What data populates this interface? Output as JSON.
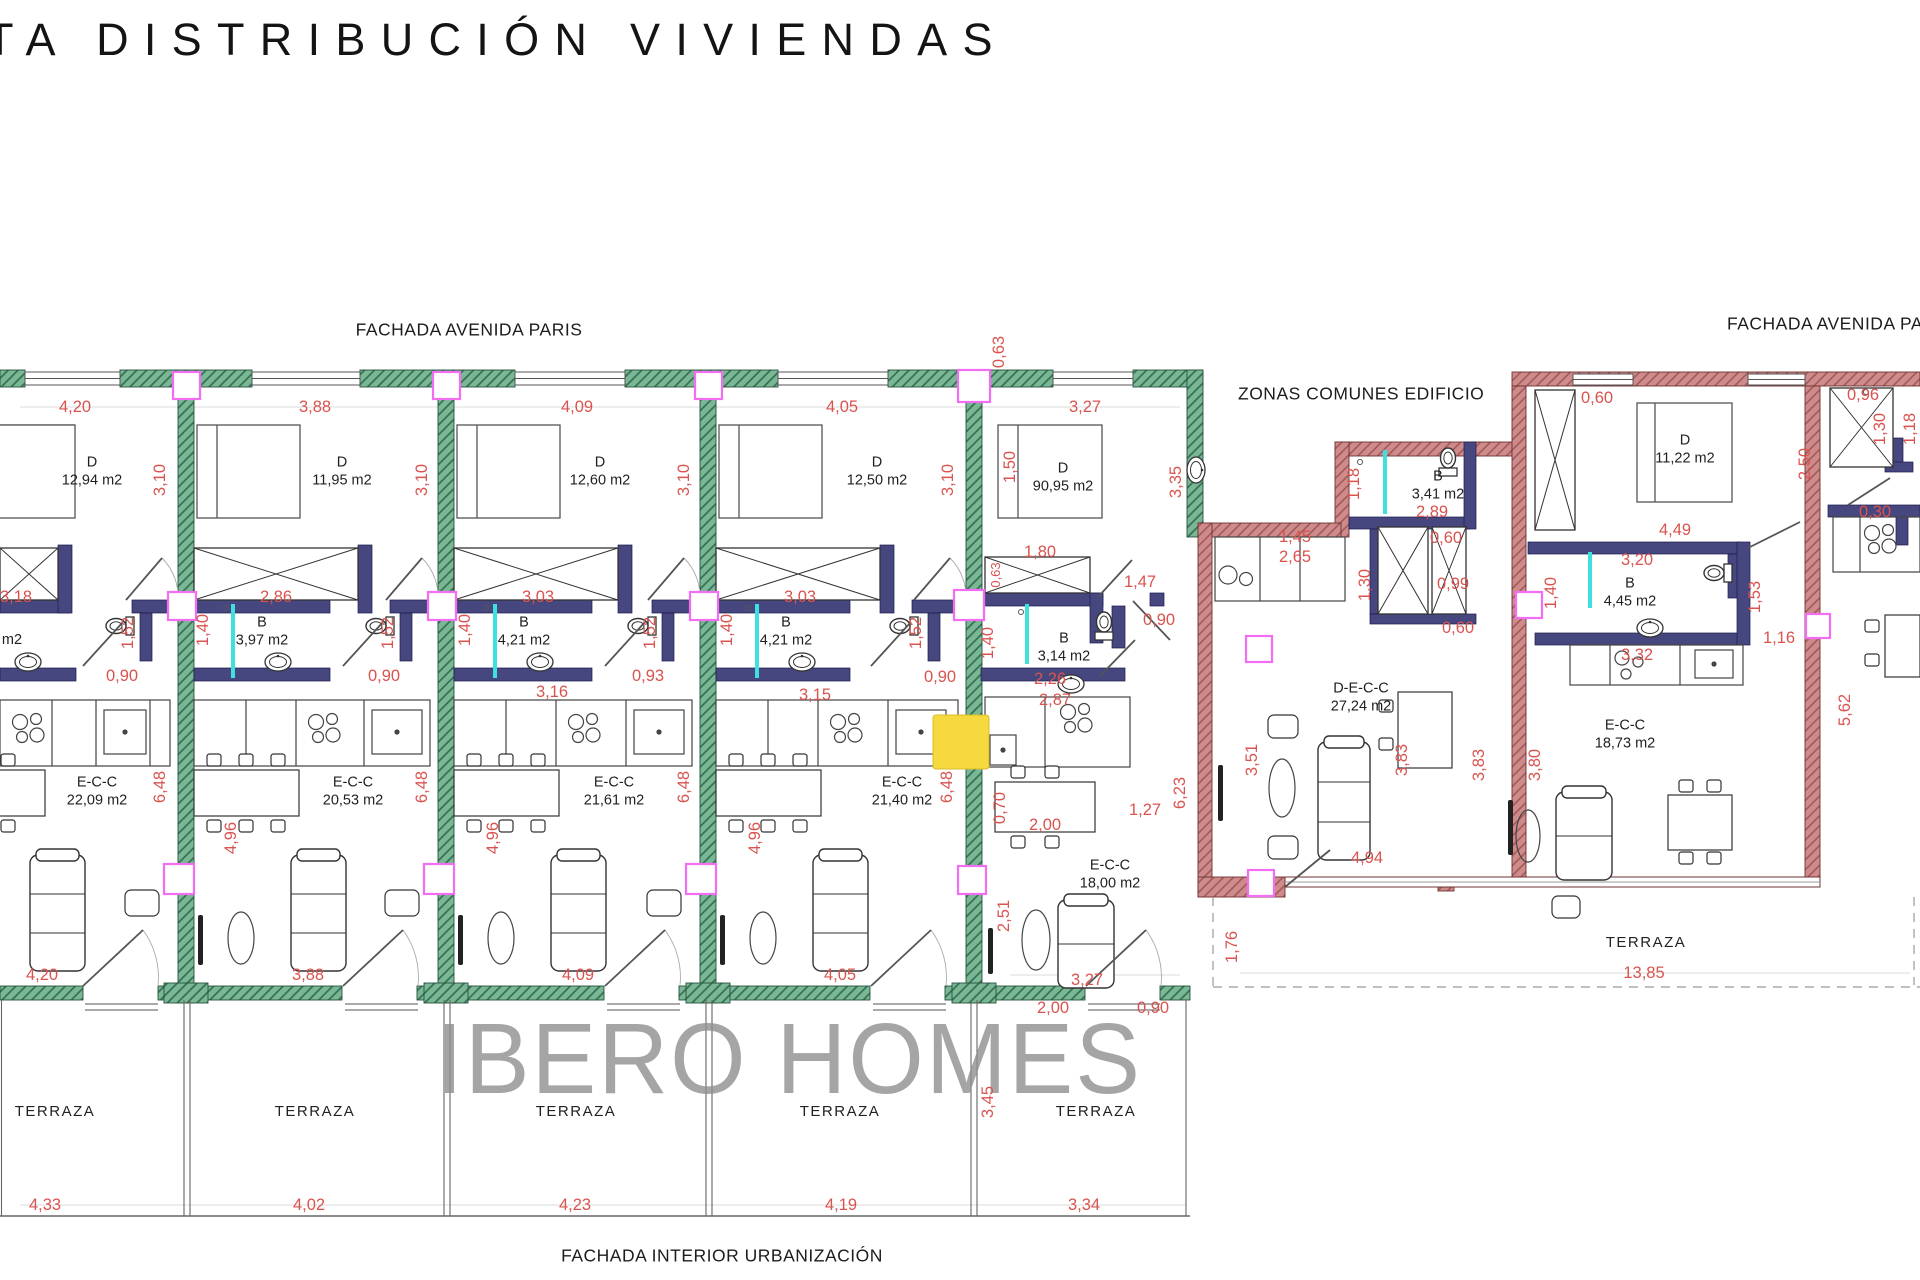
{
  "page": {
    "title": "TA DISTRIBUCIÓN VIVIENDAS",
    "watermark": "IBERO HOMES"
  },
  "colors": {
    "wall_green": "#74B694",
    "wall_red": "#CE8B8B",
    "wall_interior": "#474780",
    "dimension_red": "#D9534F",
    "column_magenta": "#F26DF2",
    "shower_cyan": "#3FE0E0",
    "highlight_yellow": "#F6D93F",
    "watermark_gray": "#8F8F8F"
  },
  "plan": {
    "facade_labels": [
      {
        "t": "FACHADA AVENIDA PARIS",
        "x": 469,
        "y": 330,
        "n": "facade-label-avenida-paris"
      },
      {
        "t": "FACHADA AVENIDA PARIS",
        "x": 1727,
        "y": 324,
        "a": "l",
        "n": "facade-label-avenida-paris-right"
      },
      {
        "t": "ZONAS COMUNES EDIFICIO",
        "x": 1238,
        "y": 394,
        "a": "l",
        "n": "zonas-comunes-label"
      },
      {
        "t": "FACHADA INTERIOR URBANIZACIÓN",
        "x": 722,
        "y": 1256,
        "n": "facade-label-interior-urbanizacion"
      }
    ],
    "room_labels": [
      {
        "t": "D\n12,94 m2",
        "x": 92,
        "y": 472,
        "n": "room-label-bedroom"
      },
      {
        "t": "D\n11,95 m2",
        "x": 342,
        "y": 472,
        "n": "room-label-bedroom"
      },
      {
        "t": "D\n12,60 m2",
        "x": 600,
        "y": 472,
        "n": "room-label-bedroom"
      },
      {
        "t": "D\n12,50 m2",
        "x": 877,
        "y": 472,
        "n": "room-label-bedroom"
      },
      {
        "t": "D\n90,95 m2",
        "x": 1063,
        "y": 478,
        "n": "room-label-bedroom"
      },
      {
        "t": "m2",
        "x": 12,
        "y": 641,
        "n": "room-label-bathroom-partial"
      },
      {
        "t": "B\n3,97 m2",
        "x": 262,
        "y": 632,
        "n": "room-label-bathroom"
      },
      {
        "t": "B\n4,21 m2",
        "x": 524,
        "y": 632,
        "n": "room-label-bathroom"
      },
      {
        "t": "B\n4,21 m2",
        "x": 786,
        "y": 632,
        "n": "room-label-bathroom"
      },
      {
        "t": "B\n3,14 m2",
        "x": 1064,
        "y": 648,
        "n": "room-label-bathroom"
      },
      {
        "t": "E-C-C\n22,09 m2",
        "x": 97,
        "y": 792,
        "n": "room-label-living"
      },
      {
        "t": "E-C-C\n20,53 m2",
        "x": 353,
        "y": 792,
        "n": "room-label-living"
      },
      {
        "t": "E-C-C\n21,61 m2",
        "x": 614,
        "y": 792,
        "n": "room-label-living"
      },
      {
        "t": "E-C-C\n21,40 m2",
        "x": 902,
        "y": 792,
        "n": "room-label-living"
      },
      {
        "t": "E-C-C\n18,00 m2",
        "x": 1110,
        "y": 875,
        "n": "room-label-living"
      },
      {
        "t": "B\n3,41 m2",
        "x": 1438,
        "y": 486,
        "n": "room-label-bathroom"
      },
      {
        "t": "D\n11,22 m2",
        "x": 1685,
        "y": 450,
        "n": "room-label-bedroom"
      },
      {
        "t": "B\n4,45 m2",
        "x": 1630,
        "y": 593,
        "n": "room-label-bathroom"
      },
      {
        "t": "D-E-C-C\n27,24 m2",
        "x": 1361,
        "y": 698,
        "n": "room-label-living"
      },
      {
        "t": "E-C-C\n18,73 m2",
        "x": 1625,
        "y": 735,
        "n": "room-label-living"
      }
    ],
    "terrace_labels": [
      {
        "t": "TERRAZA",
        "x": 55,
        "y": 1112
      },
      {
        "t": "TERRAZA",
        "x": 315,
        "y": 1112
      },
      {
        "t": "TERRAZA",
        "x": 576,
        "y": 1112
      },
      {
        "t": "TERRAZA",
        "x": 840,
        "y": 1112
      },
      {
        "t": "TERRAZA",
        "x": 1096,
        "y": 1112
      },
      {
        "t": "TERRAZA",
        "x": 1646,
        "y": 943
      }
    ],
    "dimensions": [
      {
        "t": "4,20",
        "x": 75,
        "y": 407
      },
      {
        "t": "3,88",
        "x": 315,
        "y": 407
      },
      {
        "t": "4,09",
        "x": 577,
        "y": 407
      },
      {
        "t": "4,05",
        "x": 842,
        "y": 407
      },
      {
        "t": "3,27",
        "x": 1085,
        "y": 407
      },
      {
        "t": "0,63",
        "x": 999,
        "y": 352,
        "r": -90
      },
      {
        "t": "3,10",
        "x": 160,
        "y": 480,
        "r": -90
      },
      {
        "t": "3,10",
        "x": 422,
        "y": 480,
        "r": -90
      },
      {
        "t": "3,10",
        "x": 684,
        "y": 480,
        "r": -90
      },
      {
        "t": "3,10",
        "x": 948,
        "y": 480,
        "r": -90
      },
      {
        "t": "1,50",
        "x": 1010,
        "y": 467,
        "r": -90
      },
      {
        "t": "3,35",
        "x": 1176,
        "y": 482,
        "r": -90
      },
      {
        "t": "1,80",
        "x": 1040,
        "y": 552
      },
      {
        "t": "0,63",
        "x": 996,
        "y": 575,
        "r": -90,
        "s": 13
      },
      {
        "t": "1,47",
        "x": 1140,
        "y": 582
      },
      {
        "t": "3,18",
        "x": 16,
        "y": 597
      },
      {
        "t": "2,86",
        "x": 276,
        "y": 597
      },
      {
        "t": "3,03",
        "x": 538,
        "y": 597
      },
      {
        "t": "3,03",
        "x": 800,
        "y": 597
      },
      {
        "t": "0,90",
        "x": 1159,
        "y": 620
      },
      {
        "t": "1,40",
        "x": 203,
        "y": 630,
        "r": -90
      },
      {
        "t": "1,40",
        "x": 465,
        "y": 630,
        "r": -90
      },
      {
        "t": "1,40",
        "x": 727,
        "y": 630,
        "r": -90
      },
      {
        "t": "1,40",
        "x": 988,
        "y": 643,
        "r": -90
      },
      {
        "t": "1,52",
        "x": 128,
        "y": 633,
        "r": -90
      },
      {
        "t": "1,52",
        "x": 388,
        "y": 633,
        "r": -90
      },
      {
        "t": "1,52",
        "x": 650,
        "y": 633,
        "r": -90
      },
      {
        "t": "1,52",
        "x": 916,
        "y": 633,
        "r": -90
      },
      {
        "t": "0,90",
        "x": 122,
        "y": 676
      },
      {
        "t": "0,90",
        "x": 384,
        "y": 676
      },
      {
        "t": "0,93",
        "x": 648,
        "y": 676
      },
      {
        "t": "0,90",
        "x": 940,
        "y": 677
      },
      {
        "t": "2,26",
        "x": 1050,
        "y": 679
      },
      {
        "t": "2,87",
        "x": 1055,
        "y": 700
      },
      {
        "t": "3,16",
        "x": 552,
        "y": 692
      },
      {
        "t": "3,15",
        "x": 815,
        "y": 695
      },
      {
        "t": "6,48",
        "x": 160,
        "y": 787,
        "r": -90
      },
      {
        "t": "6,48",
        "x": 422,
        "y": 787,
        "r": -90
      },
      {
        "t": "6,48",
        "x": 684,
        "y": 787,
        "r": -90
      },
      {
        "t": "6,48",
        "x": 947,
        "y": 787,
        "r": -90
      },
      {
        "t": "6,23",
        "x": 1180,
        "y": 793,
        "r": -90
      },
      {
        "t": "4,96",
        "x": 231,
        "y": 838,
        "r": -90
      },
      {
        "t": "4,96",
        "x": 493,
        "y": 838,
        "r": -90
      },
      {
        "t": "4,96",
        "x": 755,
        "y": 838,
        "r": -90
      },
      {
        "t": "0,70",
        "x": 1000,
        "y": 808,
        "r": -90
      },
      {
        "t": "2,00",
        "x": 1045,
        "y": 825
      },
      {
        "t": "1,27",
        "x": 1145,
        "y": 810
      },
      {
        "t": "2,51",
        "x": 1004,
        "y": 916,
        "r": -90
      },
      {
        "t": "4,20",
        "x": 42,
        "y": 975
      },
      {
        "t": "3,88",
        "x": 308,
        "y": 975
      },
      {
        "t": "4,09",
        "x": 578,
        "y": 975
      },
      {
        "t": "4,05",
        "x": 840,
        "y": 975
      },
      {
        "t": "3,27",
        "x": 1087,
        "y": 980
      },
      {
        "t": "2,00",
        "x": 1053,
        "y": 1008
      },
      {
        "t": "0,90",
        "x": 1153,
        "y": 1008
      },
      {
        "t": "3,45",
        "x": 988,
        "y": 1102,
        "r": -90
      },
      {
        "t": "1,76",
        "x": 1232,
        "y": 947,
        "r": -90
      },
      {
        "t": "4,33",
        "x": 45,
        "y": 1205
      },
      {
        "t": "4,02",
        "x": 309,
        "y": 1205
      },
      {
        "t": "4,23",
        "x": 575,
        "y": 1205
      },
      {
        "t": "4,19",
        "x": 841,
        "y": 1205
      },
      {
        "t": "3,34",
        "x": 1084,
        "y": 1205
      },
      {
        "t": "13,85",
        "x": 1644,
        "y": 973
      },
      {
        "t": "1,45",
        "x": 1295,
        "y": 537
      },
      {
        "t": "2,65",
        "x": 1295,
        "y": 557
      },
      {
        "t": "2,89",
        "x": 1432,
        "y": 512
      },
      {
        "t": "0,60",
        "x": 1446,
        "y": 538
      },
      {
        "t": "1,18",
        "x": 1354,
        "y": 484,
        "r": -90
      },
      {
        "t": "0,99",
        "x": 1453,
        "y": 584
      },
      {
        "t": "0,60",
        "x": 1458,
        "y": 628
      },
      {
        "t": "1,30",
        "x": 1365,
        "y": 585,
        "r": -90
      },
      {
        "t": "0,60",
        "x": 1597,
        "y": 398
      },
      {
        "t": "2,50",
        "x": 1805,
        "y": 464,
        "r": -90
      },
      {
        "t": "4,49",
        "x": 1675,
        "y": 530
      },
      {
        "t": "3,20",
        "x": 1637,
        "y": 560
      },
      {
        "t": "1,40",
        "x": 1551,
        "y": 593,
        "r": -90
      },
      {
        "t": "1,53",
        "x": 1755,
        "y": 597,
        "r": -90
      },
      {
        "t": "1,16",
        "x": 1779,
        "y": 638
      },
      {
        "t": "3,32",
        "x": 1637,
        "y": 655
      },
      {
        "t": "0,96",
        "x": 1863,
        "y": 395
      },
      {
        "t": "1,30",
        "x": 1880,
        "y": 429,
        "r": -90
      },
      {
        "t": "1,18",
        "x": 1910,
        "y": 429,
        "r": -90
      },
      {
        "t": "0,30",
        "x": 1875,
        "y": 512
      },
      {
        "t": "5,62",
        "x": 1845,
        "y": 710,
        "r": -90
      },
      {
        "t": "3,51",
        "x": 1252,
        "y": 760,
        "r": -90
      },
      {
        "t": "3,83",
        "x": 1402,
        "y": 760,
        "r": -90
      },
      {
        "t": "3,83",
        "x": 1479,
        "y": 765,
        "r": -90
      },
      {
        "t": "3,80",
        "x": 1535,
        "y": 765,
        "r": -90
      },
      {
        "t": "4,94",
        "x": 1367,
        "y": 858
      }
    ]
  }
}
